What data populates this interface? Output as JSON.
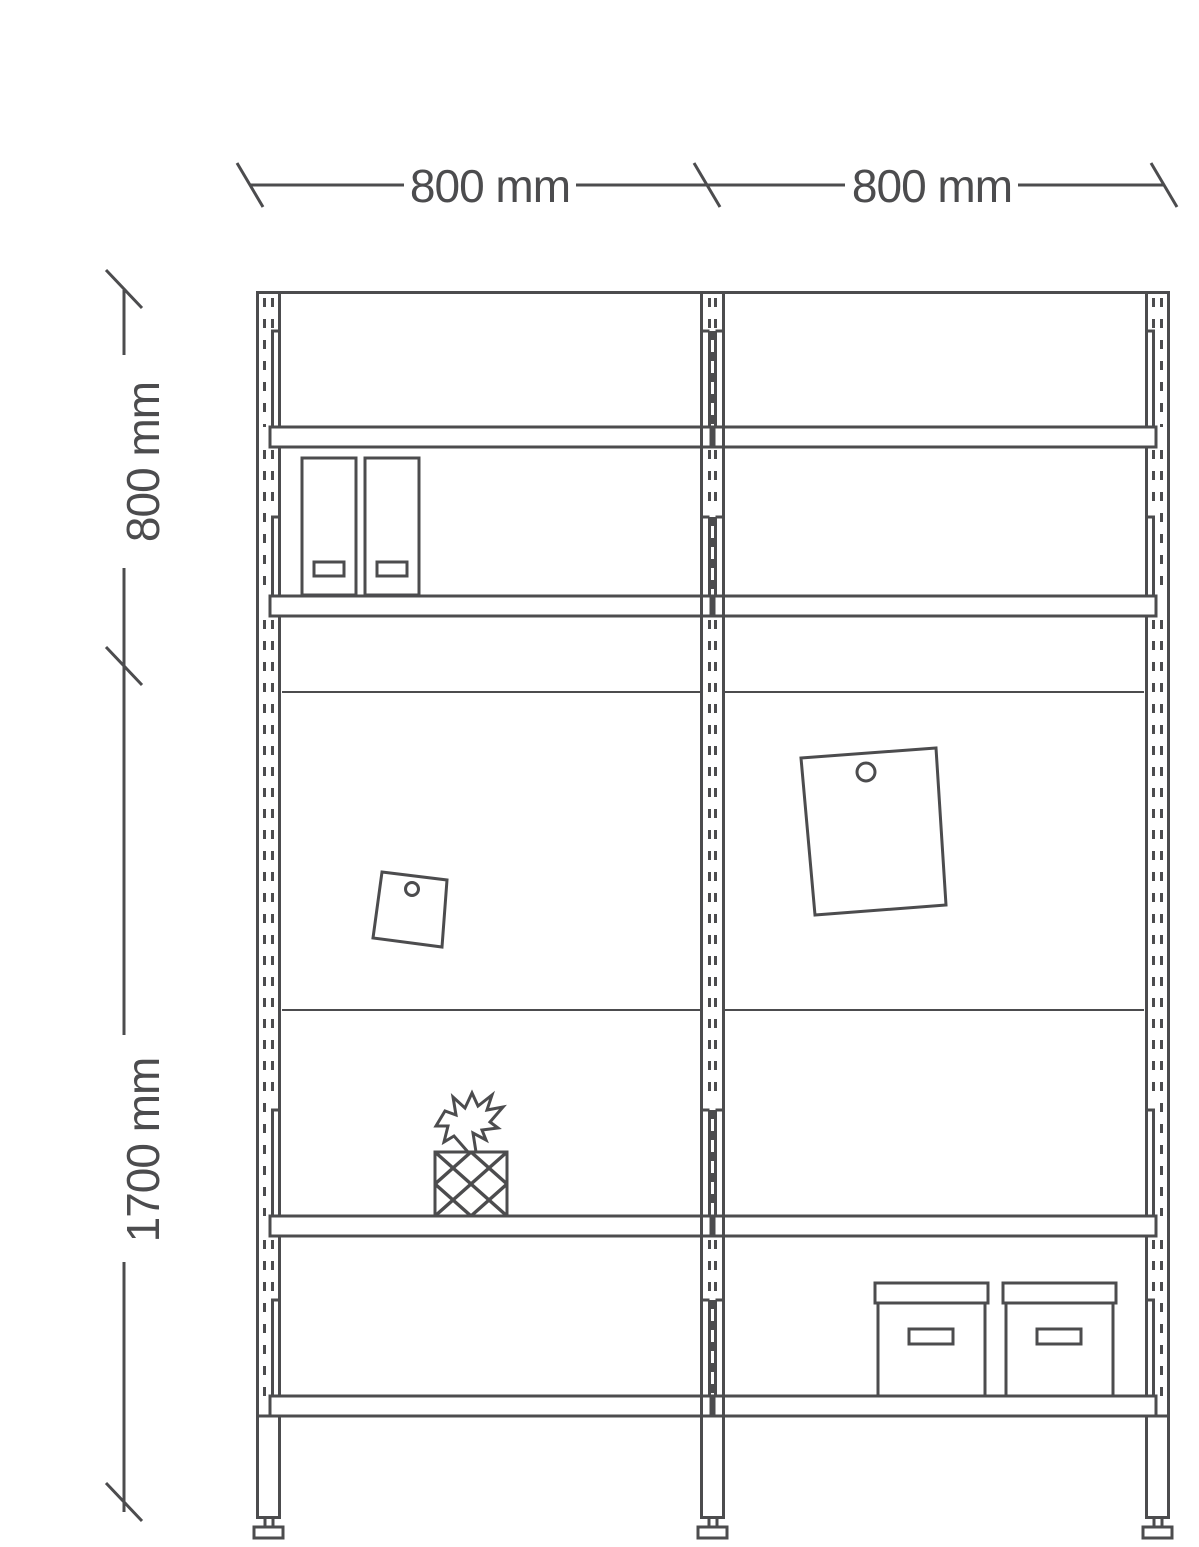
{
  "diagram": {
    "type": "furniture-dimension-drawing",
    "subject": "two-bay shelving unit, front elevation",
    "colors": {
      "line": "#4c4c4e",
      "background": "#ffffff"
    },
    "dimension_labels": {
      "top_left_width": "800 mm",
      "top_right_width": "800 mm",
      "left_upper_height": "800 mm",
      "left_total_height": "1700 mm"
    },
    "decorations": [
      "binder-icon",
      "binder-icon",
      "pinned-note-icon",
      "pinned-paper-icon",
      "pineapple-icon",
      "storage-box-icon",
      "storage-box-icon"
    ]
  }
}
